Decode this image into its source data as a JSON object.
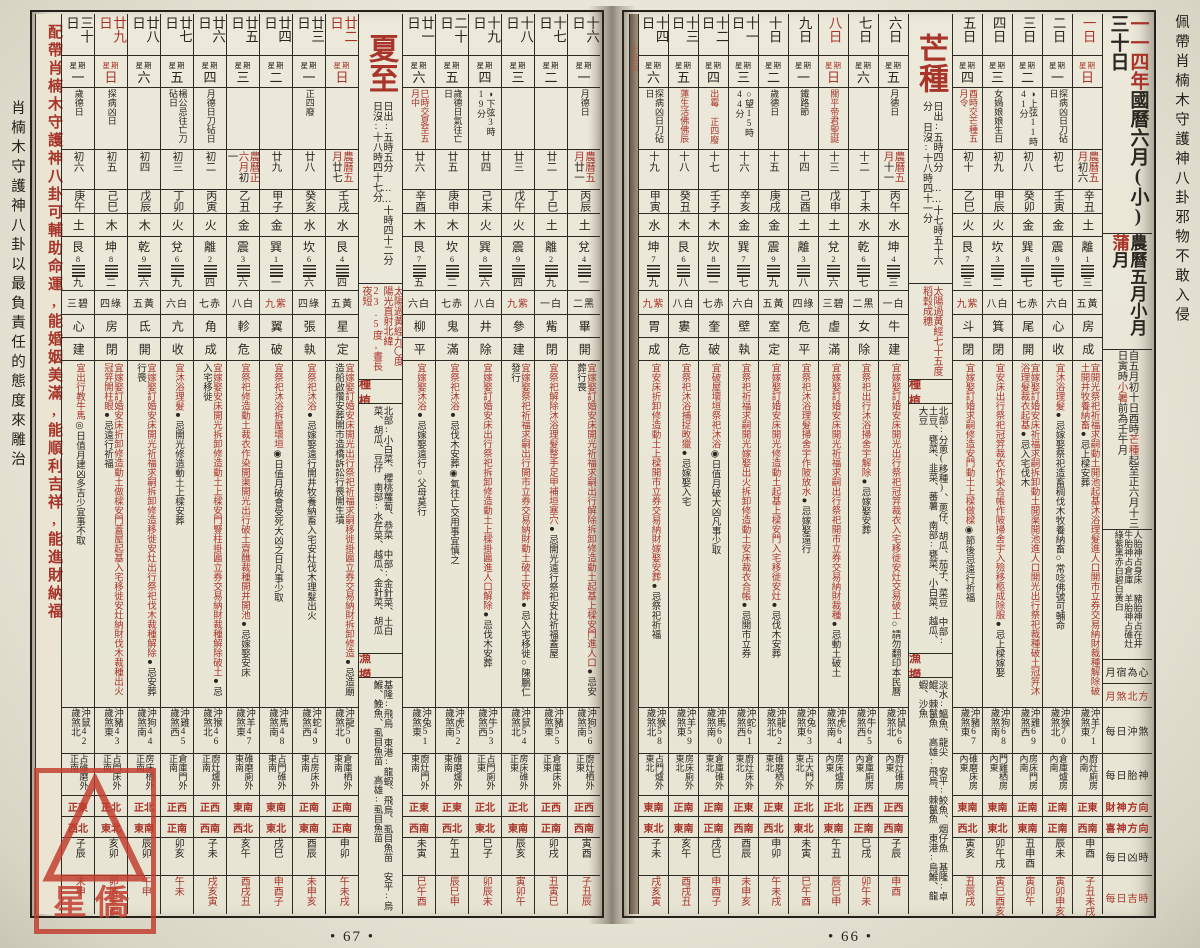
{
  "margins": {
    "right": "佩帶肖楠木守護神八卦邪物不敢入侵",
    "left": "肖楠木守護神八卦以最負責任的態度來雕治"
  },
  "stamp": {
    "text": "星僑"
  },
  "page_numbers": {
    "left": "• 67 •",
    "right": "• 66 •"
  },
  "advert": "配帶肖楠木守護神八卦可輔助命運,能婚姻美滿,能順利吉祥,能進財納福",
  "label_column": {
    "year_red": "一一四年",
    "title": "國曆六月(小)三十日",
    "month_title": "農曆五月小月",
    "month_alias_red": "蒲",
    "month_alias_rest": "月",
    "term_range": [
      "自五月初十日酉時",
      "芒種",
      "起至正六月十三日寅時",
      "小暑",
      "前為壬午月"
    ],
    "taishen_info": "人胎神占身床 豬胎神占在井 牛胎神占倉庫 羊胎神占碓灶",
    "star_colors": "綠紫黑赤白碧白黃白",
    "rows": [
      {
        "label": "月宿為心",
        "red": false
      },
      {
        "label": "月煞北方",
        "red": true
      },
      {
        "label": "每日沖煞",
        "red": false
      },
      {
        "label": "每日胎神",
        "red": false
      },
      {
        "label": "財神方向",
        "red": true
      },
      {
        "label": "喜神方向",
        "red": true
      },
      {
        "label": "每日凶時",
        "red": false
      },
      {
        "label": "每日吉時",
        "red": true
      }
    ]
  },
  "mangzhong": {
    "name": "芒種",
    "times": "日出:五時四分 ……十七時五十六分 日沒:十八時四十一分",
    "sun": "太陽過黃經七十五度 稻穀成穗",
    "plant_header": "種植",
    "plant": "北部:分蔥(移種)、蔥仔、胡瓜、茄子、菜豆 中部:土豆、甕菜、韭菜、蕃薯 南部:甕菜、小白菜、越瓜、大豆",
    "fish_header": "漁撈",
    "fish": "淡水:鰮魚、龍尖 安平:鮫魚、烟仔魚 基隆:卓鯤、棘鬣魚 高雄:飛烏、棘鬣魚 東港:烏鯸、龍蝦、沙魚"
  },
  "xiazhi": {
    "name": "夏至",
    "times": "日出:五時五分 ……十時四十二分 日沒:十八時四十七分",
    "sun": "太陽過黃經九〇度 陽光直射北緯23.5度,晝長夜短",
    "plant_header": "種植",
    "plant": "北部:小白菜、櫻桃蘿蔔、恭菜 中部:金針菜、土白菜、胡瓜、豆仔 南部:水芹菜、越瓜、金針菜、胡瓜",
    "fish_header": "漁撈",
    "fish": "基隆:飛烏 東港:龍蝦、飛烏、虱目魚苗 安平:烏鯸、鮸魚、虱目魚苗 高雄:虱目魚苗"
  },
  "day15_sliver": {
    "n": "十五日"
  },
  "days_right": [
    {
      "n": "一日",
      "w": "日",
      "red": true,
      "note": "",
      "noteRed": false,
      "lp": "農曆五月",
      "lunar": "初六",
      "gz": "辛丑",
      "wx": "土",
      "gua": "離",
      "gn": "1",
      "gs": "三",
      "star": "五黃",
      "xiu": "房",
      "jc": "成",
      "yi": "開光祭祀祈福求嗣動土開池起基沐浴理髮進人口開市立券交易納財裁種解除破土開井牧養納畜",
      "ji": "上樑安葬",
      "ex": "",
      "ch": "沖羊",
      "age": "71",
      "sh": "煞東",
      "ts": "廚灶廁房內南",
      "cai": "正東",
      "xi": "西南",
      "bad": "申酉",
      "good": "子丑未戌"
    },
    {
      "n": "二日",
      "w": "一",
      "red": false,
      "note": "探病凶日刀砧日",
      "noteRed": false,
      "lp": "",
      "lunar": "初七",
      "gz": "壬寅",
      "wx": "金",
      "gua": "震",
      "gn": "9",
      "gs": "七",
      "star": "六白",
      "xiu": "心",
      "jc": "收",
      "yi": "沐浴理髮",
      "ji": "嫁娶祭祀造畜稠伐木牧養納畜",
      "ex": "○常唸佛號可輔命",
      "ch": "沖猴",
      "age": "70",
      "sh": "煞北",
      "ts": "倉庫爐房內南",
      "cai": "正南",
      "xi": "正南",
      "bad": "辰未",
      "good": "寅卯申亥"
    },
    {
      "n": "三日",
      "w": "二",
      "red": false,
      "note": "◑上弦11時41分",
      "noteRed": false,
      "lp": "",
      "lunar": "初八",
      "gz": "癸卯",
      "wx": "金",
      "gua": "巽",
      "gn": "8",
      "gs": "七",
      "star": "七赤",
      "xiu": "尾",
      "jc": "開",
      "yi": "嫁娶訂婚安床祈福求嗣拆卸動土開渠開池進人口開光出行祭祀裁種破土冠笄沐浴理髮裁衣起基",
      "ji": "入宅伐木",
      "ex": "",
      "ch": "沖雞",
      "age": "69",
      "sh": "煞西",
      "ts": "房床門房內南",
      "cai": "正南",
      "xi": "東南",
      "bad": "丑申酉",
      "good": "寅卯午"
    },
    {
      "n": "四日",
      "w": "三",
      "red": false,
      "note": "女媧娘娘生日",
      "noteRed": false,
      "lp": "",
      "lunar": "初九",
      "gz": "甲辰",
      "wx": "火",
      "gua": "坎",
      "gn": "3",
      "gs": "二",
      "star": "八白",
      "xiu": "箕",
      "jc": "閉",
      "yi": "安床出行祭祀冠笄裁衣作染合帳作陂掃舍宇入殮移柩成除服",
      "ji": "上樑嫁娶",
      "ex": "",
      "ch": "沖狗",
      "age": "68",
      "sh": "煞南",
      "ts": "門雞栖房內東",
      "cai": "東南",
      "xi": "東北",
      "bad": "卯午戌",
      "good": "寅巳酉亥"
    },
    {
      "n": "五日",
      "w": "四",
      "red": false,
      "note": "酉時交芒種五月令",
      "noteRed": true,
      "lp": "",
      "lunar": "初十",
      "gz": "乙巳",
      "wx": "火",
      "gua": "艮",
      "gn": "7",
      "gs": "三",
      "star": "九紫",
      "xiu": "斗",
      "jc": "閉",
      "yi": "嫁娶訂婚求嗣修造安門動土上樑做樑",
      "ji": "",
      "ex": "◉節後忌遠行祈福",
      "ch": "沖豬",
      "age": "67",
      "sh": "煞東",
      "ts": "碓磨床房內東",
      "cai": "東南",
      "xi": "西北",
      "bad": "寅亥",
      "good": "丑辰戌"
    },
    {
      "n": "六日",
      "w": "五",
      "red": false,
      "note": "月德日",
      "noteRed": false,
      "lp": "農曆五月",
      "lunar": "十一",
      "gz": "丙午",
      "wx": "水",
      "gua": "坤",
      "gn": "4",
      "gs": "三",
      "star": "一白",
      "xiu": "牛",
      "jc": "建",
      "yi": "嫁娶訂婚安床開光出行祭祀冠笄裁衣入宅移徙安灶交易破土",
      "ji": "",
      "ex": "○請勿翻印本民曆",
      "ch": "沖鼠",
      "age": "66",
      "sh": "煞北",
      "ts": "廚灶碓房內東",
      "cai": "正西",
      "xi": "西南",
      "bad": "子辰",
      "good": "申酉"
    },
    {
      "n": "七日",
      "w": "六",
      "red": false,
      "note": "",
      "noteRed": false,
      "lp": "",
      "lunar": "十二",
      "gz": "丁未",
      "wx": "水",
      "gua": "乾",
      "gn": "6",
      "gs": "七",
      "star": "二黑",
      "xiu": "女",
      "jc": "除",
      "yi": "祭祀出行沐浴掃舍宇解除",
      "ji": "嫁娶安葬",
      "ex": "",
      "ch": "沖牛",
      "age": "65",
      "sh": "煞西",
      "ts": "倉庫廁房內東",
      "cai": "正西",
      "xi": "正南",
      "bad": "巳戌",
      "good": "卯午未"
    },
    {
      "n": "八日",
      "w": "日",
      "red": true,
      "note": "關平帝君聖誕",
      "noteRed": true,
      "lp": "",
      "lunar": "十三",
      "gz": "戊申",
      "wx": "土",
      "gua": "兌",
      "gn": "2",
      "gs": "六",
      "star": "三碧",
      "xiu": "虛",
      "jc": "滿",
      "yi": "嫁娶訂婚安床開光祈福求嗣出行祭祀開市立券交易納財裁種",
      "ji": "動土破土",
      "ex": "",
      "ch": "沖虎",
      "age": "64",
      "sh": "煞南",
      "ts": "房床爐房內東",
      "cai": "正北",
      "xi": "東南",
      "bad": "午丑",
      "good": "辰巳申"
    },
    {
      "n": "九日",
      "w": "一",
      "red": false,
      "note": "鐵路節",
      "noteRed": false,
      "lp": "",
      "lunar": "十四",
      "gz": "己酉",
      "wx": "土",
      "gua": "離",
      "gn": "3",
      "gs": "八",
      "star": "四綠",
      "xiu": "危",
      "jc": "平",
      "yi": "祭祀沐浴理髮掃舍宇作陂放水",
      "ji": "嫁娶遠行",
      "ex": "",
      "ch": "沖兔",
      "age": "63",
      "sh": "煞東",
      "ts": "占大門外東北",
      "cai": "正北",
      "xi": "東北",
      "bad": "未寅",
      "good": "巳午酉"
    },
    {
      "n": "十日",
      "w": "二",
      "red": false,
      "note": "歲德日",
      "noteRed": false,
      "lp": "",
      "lunar": "十五",
      "gz": "庚戌",
      "wx": "金",
      "gua": "震",
      "gn": "9",
      "gs": "九",
      "star": "五黃",
      "xiu": "室",
      "jc": "定",
      "yi": "嫁娶訂婚安床開光修造動土起基上樑安門入宅移徙安灶",
      "ji": "伐木安葬",
      "ex": "",
      "ch": "沖龍",
      "age": "62",
      "sh": "煞北",
      "ts": "碓磨栖外東北",
      "cai": "正東",
      "xi": "西北",
      "bad": "申卯",
      "good": "午未戌"
    },
    {
      "n": "十一日",
      "w": "三",
      "red": false,
      "note": "○望15時44分",
      "noteRed": false,
      "lp": "",
      "lunar": "十六",
      "gz": "辛亥",
      "wx": "金",
      "gua": "巽",
      "gn": "7",
      "gs": "七",
      "star": "六白",
      "xiu": "壁",
      "jc": "執",
      "yi": "祭祀祈福求嗣開光嫁娶出火拆卸修造動土安床裁衣合帳",
      "ji": "開市立券",
      "ex": "",
      "ch": "沖蛇",
      "age": "61",
      "sh": "煞西",
      "ts": "廚灶床外東北",
      "cai": "正東",
      "xi": "西南",
      "bad": "酉辰",
      "good": "未申亥"
    },
    {
      "n": "十二日",
      "w": "四",
      "red": false,
      "note": "出霉 正四廢",
      "noteRed": true,
      "lp": "",
      "lunar": "十七",
      "gz": "壬子",
      "wx": "木",
      "gua": "坎",
      "gn": "8",
      "gs": "一",
      "star": "七赤",
      "xiu": "奎",
      "jc": "破",
      "yi": "破屋壞垣祭祀沐浴",
      "ji": "",
      "ex": "◉日值月破大凶凡事少取",
      "ch": "沖馬",
      "age": "60",
      "sh": "煞南",
      "ts": "倉庫碓外東北",
      "cai": "正南",
      "xi": "正南",
      "bad": "戌巳",
      "good": "申酉子"
    },
    {
      "n": "十三日",
      "w": "五",
      "red": false,
      "note": "蓮生活佛佛辰",
      "noteRed": true,
      "lp": "",
      "lunar": "十八",
      "gz": "癸丑",
      "wx": "木",
      "gua": "艮",
      "gn": "6",
      "gs": "八",
      "star": "八白",
      "xiu": "婁",
      "jc": "危",
      "yi": "祭祀沐浴捕捉畋獵",
      "ji": "嫁娶入宅",
      "ex": "",
      "ch": "沖羊",
      "age": "59",
      "sh": "煞東",
      "ts": "房床廁外東北",
      "cai": "正南",
      "xi": "東南",
      "bad": "亥午",
      "good": "酉戌丑"
    },
    {
      "n": "十四日",
      "w": "六",
      "red": false,
      "note": "探病凶日刀砧日",
      "noteRed": false,
      "lp": "",
      "lunar": "十九",
      "gz": "甲寅",
      "wx": "水",
      "gua": "坤",
      "gn": "7",
      "gs": "九",
      "star": "九紫",
      "xiu": "胃",
      "jc": "成",
      "yi": "安床折卸修造動土上樑開市立券交易納財嫁娶安葬",
      "ji": "祭祀祈福",
      "ex": "",
      "ch": "沖猴",
      "age": "58",
      "sh": "煞北",
      "ts": "占門爐外東北",
      "cai": "東南",
      "xi": "東北",
      "bad": "子未",
      "good": "戌亥寅"
    }
  ],
  "days_left": [
    {
      "n": "十六日",
      "w": "一",
      "red": false,
      "note": "月德日",
      "noteRed": false,
      "lp": "農曆五月",
      "lunar": "廿一",
      "gz": "丙辰",
      "wx": "土",
      "gua": "兌",
      "gn": "4",
      "gs": "一",
      "star": "二黑",
      "xiu": "畢",
      "jc": "開",
      "yi": "嫁娶訂婚安床開光祈福求嗣出行解除拆卸修造動土起基上樑安門進人口",
      "ji": "安葬行喪",
      "ex": "",
      "ch": "沖狗",
      "age": "56",
      "sh": "煞南",
      "ts": "廚灶栖外正東",
      "cai": "正西",
      "xi": "西南",
      "bad": "寅酉",
      "good": "子丑辰"
    },
    {
      "n": "十七日",
      "w": "二",
      "red": false,
      "note": "",
      "noteRed": false,
      "lp": "",
      "lunar": "廿二",
      "gz": "丁巳",
      "wx": "土",
      "gua": "離",
      "gn": "2",
      "gs": "九",
      "star": "一白",
      "xiu": "觜",
      "jc": "閉",
      "yi": "祭祀解除沐浴理髮整手足甲補垣塞穴",
      "ji": "開光遠行祭祀安灶祈福蓋屋",
      "ex": "",
      "ch": "沖豬",
      "age": "55",
      "sh": "煞東",
      "ts": "倉庫床外正東",
      "cai": "正西",
      "xi": "正南",
      "bad": "卯戌",
      "good": "丑寅巳"
    },
    {
      "n": "十八日",
      "w": "三",
      "red": false,
      "note": "",
      "noteRed": false,
      "lp": "",
      "lunar": "廿三",
      "gz": "戊午",
      "wx": "火",
      "gua": "震",
      "gn": "9",
      "gs": "四",
      "star": "九紫",
      "xiu": "參",
      "jc": "建",
      "yi": "嫁娶祭祀祈福求嗣出行開市立券交易納財動土破土安葬",
      "ji": "入宅移徙",
      "ex": "○陳鵬仁發行",
      "ch": "沖鼠",
      "age": "54",
      "sh": "煞北",
      "ts": "房床碓外正東",
      "cai": "正北",
      "xi": "東南",
      "bad": "辰亥",
      "good": "寅卯午"
    },
    {
      "n": "十九日",
      "w": "四",
      "red": false,
      "note": "◑下弦3時19分",
      "noteRed": false,
      "lp": "",
      "lunar": "廿四",
      "gz": "己未",
      "wx": "火",
      "gua": "巽",
      "gn": "8",
      "gs": "六",
      "star": "八白",
      "xiu": "井",
      "jc": "除",
      "yi": "嫁娶訂婚安床出行祭祀拆卸修造動土上樑掛匾進人口解除",
      "ji": "伐木安葬",
      "ex": "",
      "ch": "沖牛",
      "age": "53",
      "sh": "煞西",
      "ts": "占門廁外正東",
      "cai": "正北",
      "xi": "東北",
      "bad": "巳子",
      "good": "卯辰未"
    },
    {
      "n": "二十日",
      "w": "五",
      "red": false,
      "note": "歲德日氣往亡日",
      "noteRed": false,
      "lp": "",
      "lunar": "廿五",
      "gz": "庚申",
      "wx": "木",
      "gua": "坎",
      "gn": "6",
      "gs": "二",
      "star": "七赤",
      "xiu": "鬼",
      "jc": "滿",
      "yi": "祭祀沐浴",
      "ji": "伐木安葬",
      "ex": "◉氣往亡交用事宜慎之",
      "ch": "沖虎",
      "age": "52",
      "sh": "煞南",
      "ts": "碓磨爐外東南",
      "cai": "正東",
      "xi": "西北",
      "bad": "午丑",
      "good": "辰巳申"
    },
    {
      "n": "廿一日",
      "w": "六",
      "red": false,
      "note": "巳時交夏至五月中",
      "noteRed": true,
      "lp": "",
      "lunar": "廿六",
      "gz": "辛酉",
      "wx": "木",
      "gua": "艮",
      "gn": "7",
      "gs": "五",
      "star": "六白",
      "xiu": "柳",
      "jc": "平",
      "yi": "嫁娶沐浴",
      "ji": "嫁娶遠行",
      "ex": "○父母莫行",
      "ch": "沖兔",
      "age": "51",
      "sh": "煞東",
      "ts": "廚灶門外東南",
      "cai": "正東",
      "xi": "西南",
      "bad": "未寅",
      "good": "巳午酉"
    },
    {
      "n": "廿二日",
      "w": "日",
      "red": true,
      "note": "",
      "noteRed": false,
      "lp": "農曆五月",
      "lunar": "廿七",
      "gz": "壬戌",
      "wx": "水",
      "gua": "艮",
      "gn": "4",
      "gs": "四",
      "star": "五黃",
      "xiu": "星",
      "jc": "定",
      "yi": "嫁娶訂婚安床開光出行祭祀祈福求嗣移徙掛匾立券交易納財拆卸修造",
      "ji": "造廟造船啟攢安葬開市造橋訴訟行喪開生墳",
      "ex": "",
      "ch": "沖龍",
      "age": "50",
      "sh": "煞北",
      "ts": "倉庫栖外東南",
      "cai": "正南",
      "xi": "正南",
      "bad": "申卯",
      "good": "午未戌"
    },
    {
      "n": "廿三日",
      "w": "一",
      "red": false,
      "note": "正四廢",
      "noteRed": false,
      "lp": "",
      "lunar": "廿八",
      "gz": "癸亥",
      "wx": "水",
      "gua": "坎",
      "gn": "6",
      "gs": "六",
      "star": "四綠",
      "xiu": "張",
      "jc": "執",
      "yi": "祭祀沐浴",
      "ji": "嫁娶遠行開井牧養納畜入宅安灶伐木理髮出火",
      "ex": "",
      "ch": "沖蛇",
      "age": "49",
      "sh": "煞西",
      "ts": "占房床外東南",
      "cai": "正南",
      "xi": "東南",
      "bad": "酉辰",
      "good": "未申亥"
    },
    {
      "n": "廿四日",
      "w": "二",
      "red": false,
      "note": "",
      "noteRed": false,
      "lp": "",
      "lunar": "廿九",
      "gz": "甲子",
      "wx": "金",
      "gua": "巽",
      "gn": "1",
      "gs": "一",
      "star": "九紫",
      "xiu": "翼",
      "jc": "破",
      "yi": "祭祀沐浴拆屋壞垣",
      "ji": "",
      "ex": "◉日值月破會受死大凶之日凡事少取",
      "ch": "沖馬",
      "age": "48",
      "sh": "煞南",
      "ts": "占門碓外東南",
      "cai": "東南",
      "xi": "東北",
      "bad": "戌巳",
      "good": "申酉子"
    },
    {
      "n": "廿五日",
      "w": "三",
      "red": false,
      "note": "",
      "noteRed": false,
      "lp": "農曆正六月",
      "lunar": "初一",
      "gz": "乙丑",
      "wx": "金",
      "gua": "震",
      "gn": "3",
      "gs": "六",
      "star": "八白",
      "xiu": "軫",
      "jc": "危",
      "yi": "祭祀修造動土裁衣作染開渠開光出行破土齋醮裁種開井開池",
      "ji": "嫁娶安床",
      "ex": "",
      "ch": "沖羊",
      "age": "47",
      "sh": "煞東",
      "ts": "碓磨廁外東南",
      "cai": "東南",
      "xi": "西北",
      "bad": "亥午",
      "good": "酉戌丑"
    },
    {
      "n": "廿六日",
      "w": "四",
      "red": false,
      "note": "月德日刀砧日",
      "noteRed": false,
      "lp": "",
      "lunar": "初二",
      "gz": "丙寅",
      "wx": "火",
      "gua": "離",
      "gn": "2",
      "gs": "四",
      "star": "七赤",
      "xiu": "角",
      "jc": "成",
      "yi": "嫁娶安床開光拆卸修造動土上樑安門豎柱掛匾立券交易納財裁種解除破土",
      "ji": "入宅移徙",
      "ex": "",
      "ch": "沖猴",
      "age": "46",
      "sh": "煞北",
      "ts": "廚灶爐外正南",
      "cai": "正西",
      "xi": "西南",
      "bad": "子未",
      "good": "戌亥寅"
    },
    {
      "n": "廿七日",
      "w": "五",
      "red": false,
      "note": "楊公忌往亡刀砧日",
      "noteRed": false,
      "lp": "",
      "lunar": "初三",
      "gz": "丁卯",
      "wx": "火",
      "gua": "兌",
      "gn": "6",
      "gs": "九",
      "star": "六白",
      "xiu": "亢",
      "jc": "收",
      "yi": "沐浴理髮",
      "ji": "開光修造動土上樑安葬",
      "ex": "",
      "ch": "沖雞",
      "age": "45",
      "sh": "煞西",
      "ts": "倉庫門外正南",
      "cai": "正西",
      "xi": "正南",
      "bad": "卯亥",
      "good": "午未"
    },
    {
      "n": "廿八日",
      "w": "六",
      "red": false,
      "note": "",
      "noteRed": false,
      "lp": "",
      "lunar": "初四",
      "gz": "戊辰",
      "wx": "木",
      "gua": "乾",
      "gn": "9",
      "gs": "六",
      "star": "五黃",
      "xiu": "氐",
      "jc": "開",
      "yi": "嫁娶訂婚安床開光祈福求嗣拆卸修造移徙安灶出行祭祀伐木裁種解除",
      "ji": "安葬行喪",
      "ex": "",
      "ch": "沖狗",
      "age": "44",
      "sh": "煞南",
      "ts": "房床栖外正南",
      "cai": "正北",
      "xi": "東南",
      "bad": "辰卯",
      "good": "午申"
    },
    {
      "n": "廿九日",
      "w": "日",
      "red": true,
      "note": "探病凶日",
      "noteRed": false,
      "lp": "",
      "lunar": "初五",
      "gz": "己巳",
      "wx": "木",
      "gua": "坤",
      "gn": "8",
      "gs": "二",
      "star": "四綠",
      "xiu": "房",
      "jc": "閉",
      "yi": "嫁娶訂婚安床折卸修造動土做樑安門蓋屋起基入宅移徙安灶納財伐木裁種出火冠笄開柱眼",
      "ji": "遠行祈福",
      "ex": "",
      "ch": "沖豬",
      "age": "43",
      "sh": "煞東",
      "ts": "占門床外正南",
      "cai": "正北",
      "xi": "東北",
      "bad": "亥卯",
      "good": "卯辰未酉"
    },
    {
      "n": "三十日",
      "w": "一",
      "red": false,
      "note": "歲德日",
      "noteRed": false,
      "lp": "",
      "lunar": "初六",
      "gz": "庚午",
      "wx": "土",
      "gua": "艮",
      "gn": "8",
      "gs": "九",
      "star": "三碧",
      "xiu": "心",
      "jc": "建",
      "yi": "出行教牛馬",
      "ji": "",
      "ex": "◎日值月建凶多吉少宜事不取",
      "ch": "沖鼠",
      "age": "42",
      "sh": "煞北",
      "ts": "占碓磨外正南",
      "cai": "正東",
      "xi": "西北",
      "bad": "子辰",
      "good": "未申"
    }
  ]
}
